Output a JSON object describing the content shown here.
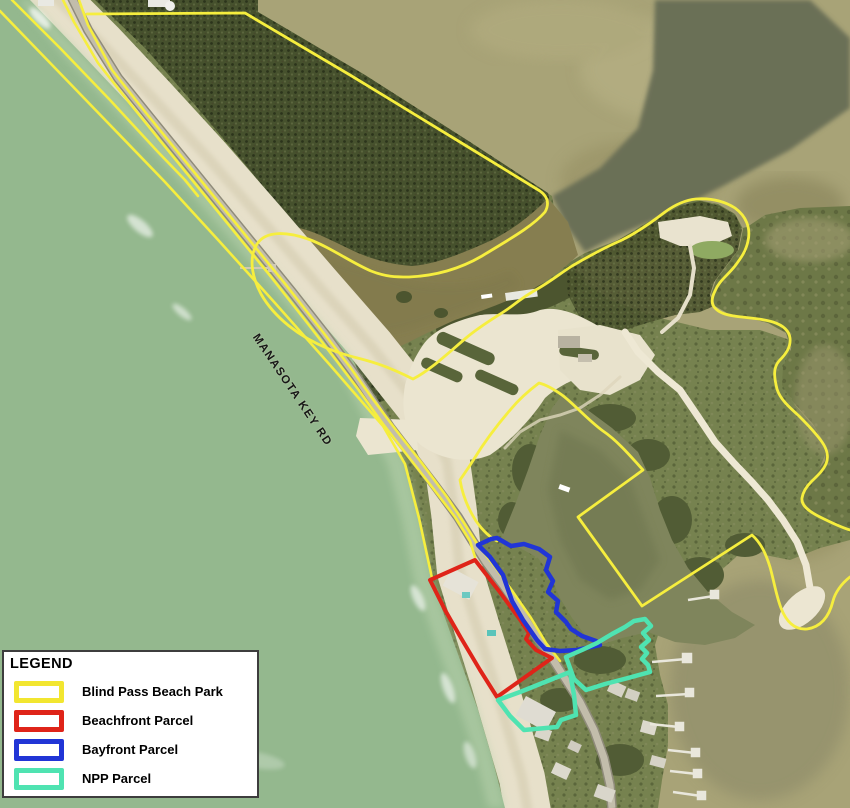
{
  "map": {
    "road_label": "MANASOTA KEY RD"
  },
  "legend": {
    "title": "LEGEND",
    "items": [
      {
        "label": "Blind Pass Beach Park",
        "color": "#f2e630"
      },
      {
        "label": "Beachfront Parcel",
        "color": "#df2419"
      },
      {
        "label": "Bayfront Parcel",
        "color": "#2135d6"
      },
      {
        "label": "NPP Parcel",
        "color": "#4fe3b1"
      }
    ]
  },
  "colors": {
    "park_boundary": "#f6ee3e",
    "beachfront_parcel": "#df2419",
    "bayfront_parcel": "#2135d6",
    "npp_parcel": "#4fe3b1"
  }
}
